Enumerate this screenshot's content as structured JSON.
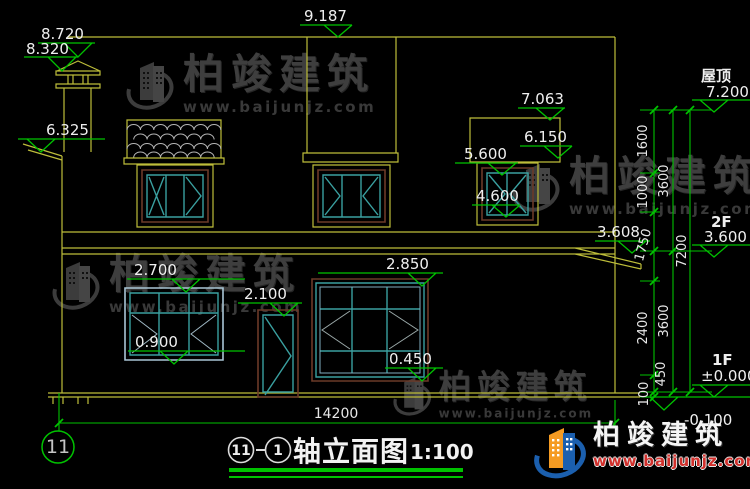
{
  "drawing": {
    "levels": {
      "chimney_top": "8.720",
      "chimney_cap": "8.320",
      "ridge": "9.187",
      "left_eave": "6.325",
      "right_dormer_top": "7.063",
      "right_canopy": "6.150",
      "f2_window_head": "5.600",
      "f2_window_sill": "4.600",
      "right_eave": "3.608",
      "f1_window_head": "2.700",
      "door_head": "2.100",
      "f1_window_sill": "0.900",
      "f1_bigwindow_head": "2.850",
      "f1_bigwindow_sill": "0.450"
    },
    "floor_marks": {
      "roof_label": "屋顶",
      "roof_value": "7.200",
      "f2_label": "2F",
      "f2_value": "3.600",
      "f1_label": "1F",
      "f1_value": "±0.000",
      "ground_value": "-0.100"
    },
    "dims": {
      "seg_1600": "1600",
      "seg_1000": "1000",
      "seg_1750": "1750",
      "seg_2400": "2400",
      "seg_450": "450",
      "seg_100": "100",
      "floor_upper": "3600",
      "floor_lower": "3600",
      "total_height": "7200",
      "total_width": "14200"
    },
    "axis_bubble": "11"
  },
  "title_block": {
    "axis_start": "11",
    "axis_end": "1",
    "name": "轴立面图",
    "scale": "1:100"
  },
  "brand": {
    "name": "柏竣建筑",
    "url": "www.baijunjz.com"
  },
  "watermark": {
    "name": "柏竣建筑",
    "url": "www.baijunjz.com"
  }
}
